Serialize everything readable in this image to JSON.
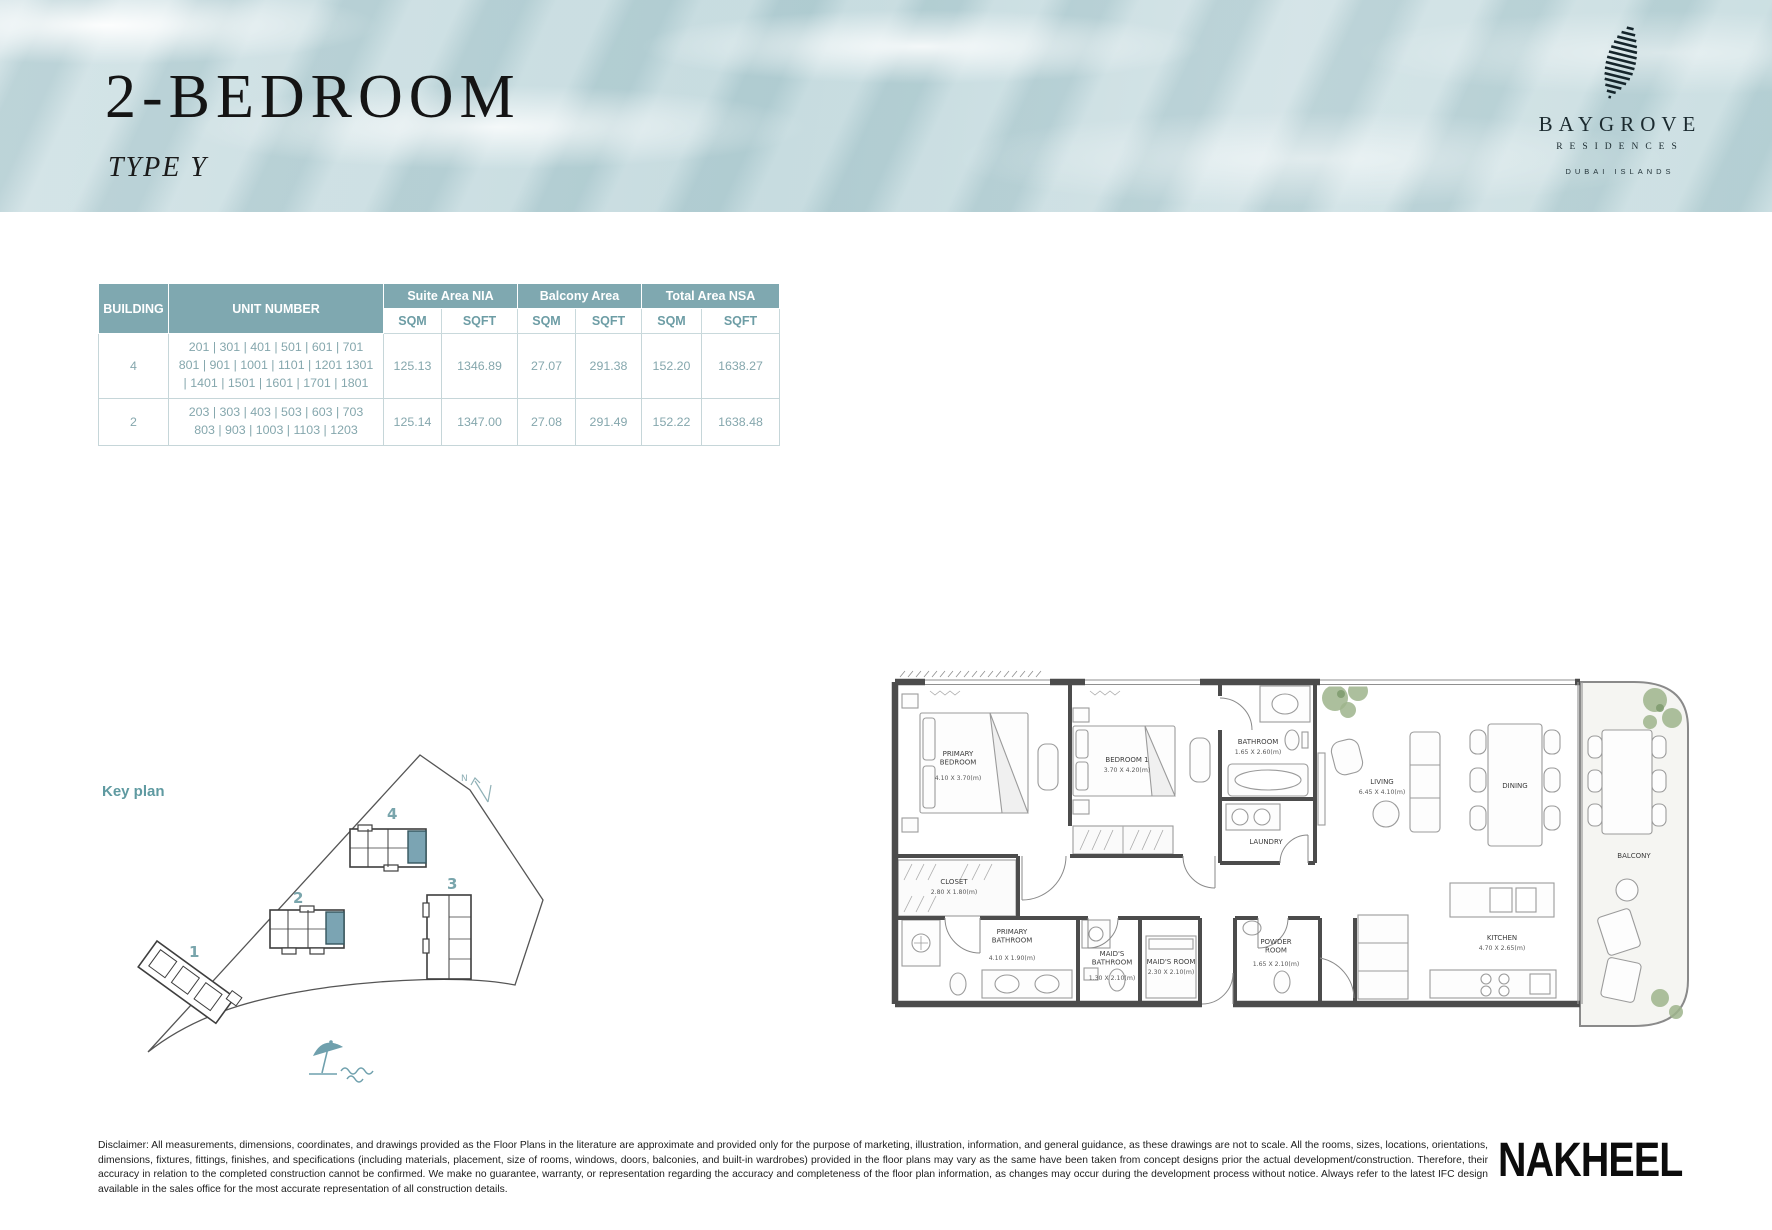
{
  "header": {
    "title": "2-BEDROOM",
    "subtitle": "TYPE Y",
    "brand": {
      "name": "BAYGROVE",
      "sub": "RESIDENCES",
      "location": "DUBAI ISLANDS"
    }
  },
  "table": {
    "headers": {
      "building": "BUILDING",
      "unit": "UNIT NUMBER",
      "suite": "Suite Area NIA",
      "balcony": "Balcony Area",
      "total": "Total Area NSA",
      "sqm": "SQM",
      "sqft": "SQFT"
    },
    "rows": [
      {
        "building": "4",
        "units": "201 | 301 | 401 | 501 | 601 | 701\n801 | 901 | 1001 | 1101 | 1201 1301\n| 1401 | 1501 | 1601 | 1701 | 1801",
        "suite_sqm": "125.13",
        "suite_sqft": "1346.89",
        "balcony_sqm": "27.07",
        "balcony_sqft": "291.38",
        "total_sqm": "152.20",
        "total_sqft": "1638.27"
      },
      {
        "building": "2",
        "units": "203 | 303 | 403 | 503 | 603 | 703\n803 | 903 | 1003 | 1103 | 1203",
        "suite_sqm": "125.14",
        "suite_sqft": "1347.00",
        "balcony_sqm": "27.08",
        "balcony_sqft": "291.49",
        "total_sqm": "152.22",
        "total_sqft": "1638.48"
      }
    ]
  },
  "key_plan": {
    "label": "Key plan",
    "north": "N",
    "buildings": [
      {
        "label": "1"
      },
      {
        "label": "2"
      },
      {
        "label": "3"
      },
      {
        "label": "4"
      }
    ]
  },
  "floor_plan": {
    "rooms": [
      {
        "name": "PRIMARY\nBEDROOM",
        "dims": "4.10 X 3.70(m)"
      },
      {
        "name": "BEDROOM 1",
        "dims": "3.70 X 4.20(m)"
      },
      {
        "name": "BATHROOM",
        "dims": "1.65 X 2.60(m)"
      },
      {
        "name": "LAUNDRY",
        "dims": ""
      },
      {
        "name": "CLOSET",
        "dims": "2.80 X 1.80(m)"
      },
      {
        "name": "PRIMARY\nBATHROOM",
        "dims": "4.10 X 1.90(m)"
      },
      {
        "name": "MAID'S\nBATHROOM",
        "dims": "1.30 X 2.10(m)"
      },
      {
        "name": "MAID'S ROOM",
        "dims": "2.30 X 2.10(m)"
      },
      {
        "name": "POWDER\nROOM",
        "dims": "1.65 X 2.10(m)"
      },
      {
        "name": "LIVING",
        "dims": "6.45 X 4.10(m)"
      },
      {
        "name": "DINING",
        "dims": ""
      },
      {
        "name": "KITCHEN",
        "dims": "4.70 X 2.65(m)"
      },
      {
        "name": "BALCONY",
        "dims": ""
      }
    ]
  },
  "footer": {
    "disclaimer": "Disclaimer: All measurements, dimensions, coordinates, and drawings provided as the Floor Plans in the literature are approximate and provided only for the purpose of marketing, illustration, information, and general guidance, as these drawings are not to scale. All the rooms, sizes, locations, orientations, dimensions, fixtures, fittings, finishes, and specifications (including materials, placement, size of rooms, windows, doors, balconies, and built-in wardrobes) provided in the floor plans may vary as the same have been taken from concept designs prior the actual development/construction. Therefore, their accuracy in relation to the completed construction cannot be confirmed. We make no guarantee, warranty, or representation regarding the accuracy and completeness of the floor plan information, as changes may occur during the development process without notice. Always refer to the latest IFC design available in the sales office for the most accurate representation of all construction details.",
    "brand": "NAKHEEL"
  },
  "colors": {
    "accent_teal": "#7fa8b0",
    "table_text": "#85a7ad",
    "wall_gray": "#4c4c4c"
  }
}
